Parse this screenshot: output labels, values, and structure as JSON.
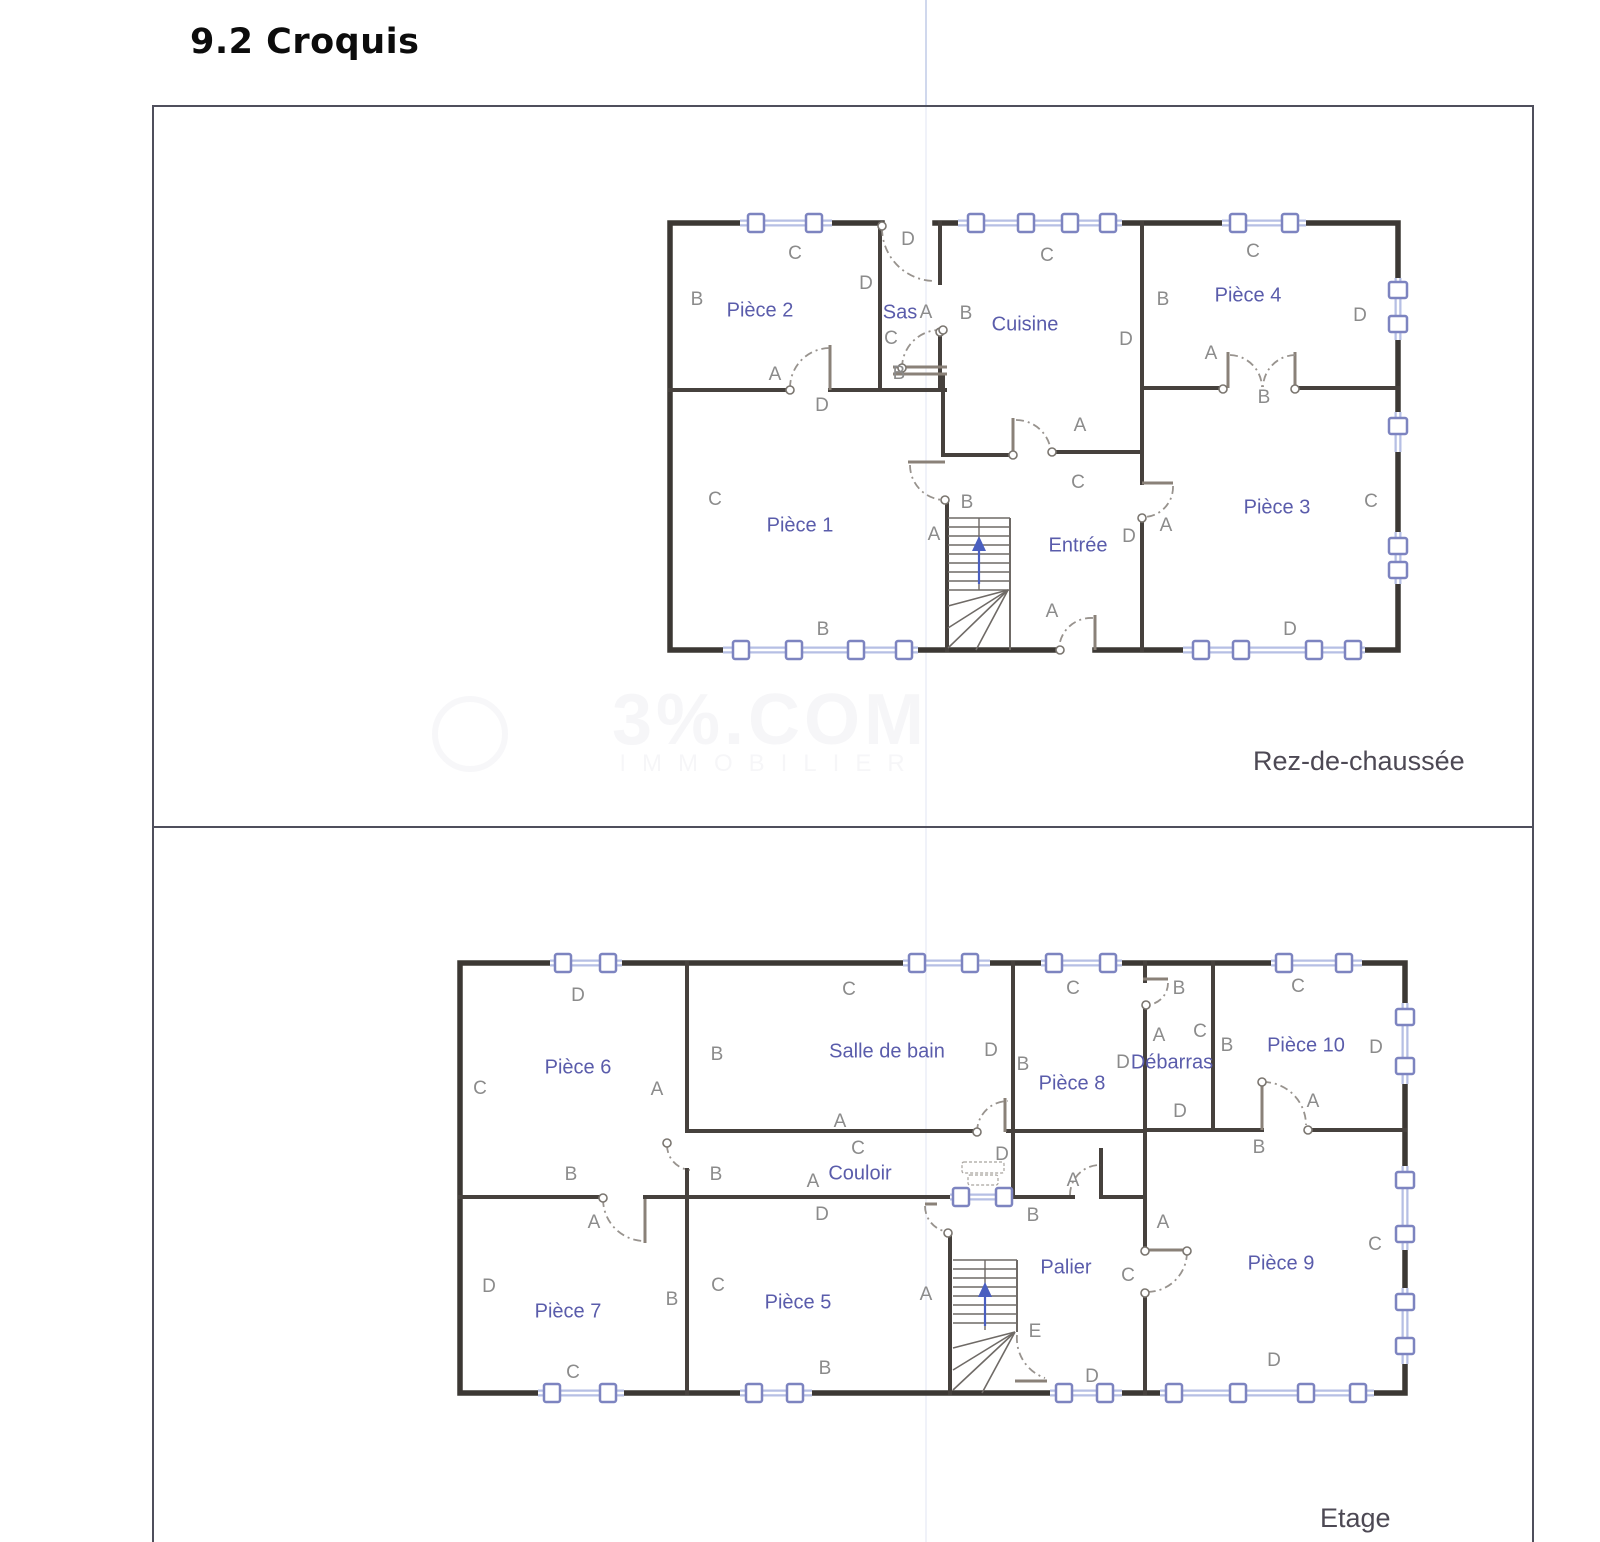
{
  "page": {
    "title": "9.2 Croquis"
  },
  "watermark": {
    "line1": "3%.COM",
    "line2": "IMMOBILIER"
  },
  "floors": [
    {
      "name": "Rez-de-chaussée",
      "rooms": [
        {
          "label": "Pièce 2",
          "x": 760,
          "y": 311
        },
        {
          "label": "Sas",
          "x": 900,
          "y": 313
        },
        {
          "label": "Cuisine",
          "x": 1025,
          "y": 325
        },
        {
          "label": "Pièce 4",
          "x": 1248,
          "y": 296
        },
        {
          "label": "Pièce 1",
          "x": 800,
          "y": 526
        },
        {
          "label": "Entrée",
          "x": 1078,
          "y": 546
        },
        {
          "label": "Pièce 3",
          "x": 1277,
          "y": 508
        }
      ],
      "letters": [
        {
          "t": "C",
          "x": 795,
          "y": 254
        },
        {
          "t": "B",
          "x": 697,
          "y": 300
        },
        {
          "t": "D",
          "x": 908,
          "y": 240
        },
        {
          "t": "D",
          "x": 866,
          "y": 284
        },
        {
          "t": "A",
          "x": 775,
          "y": 375
        },
        {
          "t": "D",
          "x": 822,
          "y": 406
        },
        {
          "t": "C",
          "x": 891,
          "y": 339
        },
        {
          "t": "A",
          "x": 926,
          "y": 313
        },
        {
          "t": "B",
          "x": 966,
          "y": 314
        },
        {
          "t": "B",
          "x": 899,
          "y": 374
        },
        {
          "t": "C",
          "x": 1047,
          "y": 256
        },
        {
          "t": "D",
          "x": 1126,
          "y": 340
        },
        {
          "t": "B",
          "x": 1163,
          "y": 300
        },
        {
          "t": "A",
          "x": 1211,
          "y": 354
        },
        {
          "t": "A",
          "x": 1080,
          "y": 426
        },
        {
          "t": "C",
          "x": 1253,
          "y": 252
        },
        {
          "t": "B",
          "x": 1264,
          "y": 398
        },
        {
          "t": "D",
          "x": 1360,
          "y": 316
        },
        {
          "t": "C",
          "x": 715,
          "y": 500
        },
        {
          "t": "B",
          "x": 823,
          "y": 630
        },
        {
          "t": "B",
          "x": 967,
          "y": 503
        },
        {
          "t": "A",
          "x": 934,
          "y": 535
        },
        {
          "t": "C",
          "x": 1078,
          "y": 483
        },
        {
          "t": "D",
          "x": 1129,
          "y": 537
        },
        {
          "t": "A",
          "x": 1166,
          "y": 526
        },
        {
          "t": "C",
          "x": 1371,
          "y": 502
        },
        {
          "t": "D",
          "x": 1290,
          "y": 630
        },
        {
          "t": "A",
          "x": 1052,
          "y": 612
        }
      ]
    },
    {
      "name": "Etage",
      "rooms": [
        {
          "label": "Pièce 6",
          "x": 578,
          "y": 1068
        },
        {
          "label": "Salle de bain",
          "x": 887,
          "y": 1052
        },
        {
          "label": "Pièce 8",
          "x": 1072,
          "y": 1084
        },
        {
          "label": "Débarras",
          "x": 1172,
          "y": 1063,
          "s": 16
        },
        {
          "label": "Pièce 10",
          "x": 1306,
          "y": 1046
        },
        {
          "label": "Pièce 7",
          "x": 568,
          "y": 1312
        },
        {
          "label": "Pièce 5",
          "x": 798,
          "y": 1303
        },
        {
          "label": "Couloir",
          "x": 860,
          "y": 1174
        },
        {
          "label": "Palier",
          "x": 1066,
          "y": 1268
        },
        {
          "label": "Pièce 9",
          "x": 1281,
          "y": 1264
        }
      ],
      "letters": [
        {
          "t": "D",
          "x": 578,
          "y": 996
        },
        {
          "t": "C",
          "x": 480,
          "y": 1089
        },
        {
          "t": "A",
          "x": 657,
          "y": 1090
        },
        {
          "t": "B",
          "x": 717,
          "y": 1055
        },
        {
          "t": "B",
          "x": 571,
          "y": 1175
        },
        {
          "t": "B",
          "x": 716,
          "y": 1175
        },
        {
          "t": "D",
          "x": 489,
          "y": 1287
        },
        {
          "t": "A",
          "x": 594,
          "y": 1223
        },
        {
          "t": "C",
          "x": 573,
          "y": 1373
        },
        {
          "t": "B",
          "x": 672,
          "y": 1300
        },
        {
          "t": "C",
          "x": 718,
          "y": 1286
        },
        {
          "t": "B",
          "x": 825,
          "y": 1369
        },
        {
          "t": "A",
          "x": 840,
          "y": 1122
        },
        {
          "t": "C",
          "x": 858,
          "y": 1149
        },
        {
          "t": "A",
          "x": 813,
          "y": 1182
        },
        {
          "t": "D",
          "x": 822,
          "y": 1215
        },
        {
          "t": "D",
          "x": 1002,
          "y": 1155
        },
        {
          "t": "C",
          "x": 849,
          "y": 990
        },
        {
          "t": "D",
          "x": 991,
          "y": 1051
        },
        {
          "t": "C",
          "x": 1073,
          "y": 989
        },
        {
          "t": "B",
          "x": 1023,
          "y": 1065
        },
        {
          "t": "D",
          "x": 1123,
          "y": 1063
        },
        {
          "t": "B",
          "x": 1179,
          "y": 989
        },
        {
          "t": "A",
          "x": 1159,
          "y": 1036
        },
        {
          "t": "C",
          "x": 1200,
          "y": 1032
        },
        {
          "t": "D",
          "x": 1180,
          "y": 1112
        },
        {
          "t": "C",
          "x": 1298,
          "y": 987
        },
        {
          "t": "B",
          "x": 1227,
          "y": 1046
        },
        {
          "t": "D",
          "x": 1376,
          "y": 1048
        },
        {
          "t": "A",
          "x": 1313,
          "y": 1102
        },
        {
          "t": "B",
          "x": 1259,
          "y": 1148
        },
        {
          "t": "B",
          "x": 1033,
          "y": 1216
        },
        {
          "t": "A",
          "x": 1073,
          "y": 1181
        },
        {
          "t": "A",
          "x": 926,
          "y": 1295
        },
        {
          "t": "E",
          "x": 1035,
          "y": 1332
        },
        {
          "t": "D",
          "x": 1092,
          "y": 1377
        },
        {
          "t": "C",
          "x": 1128,
          "y": 1276
        },
        {
          "t": "A",
          "x": 1163,
          "y": 1223
        },
        {
          "t": "C",
          "x": 1375,
          "y": 1245
        },
        {
          "t": "D",
          "x": 1274,
          "y": 1361
        }
      ]
    }
  ]
}
